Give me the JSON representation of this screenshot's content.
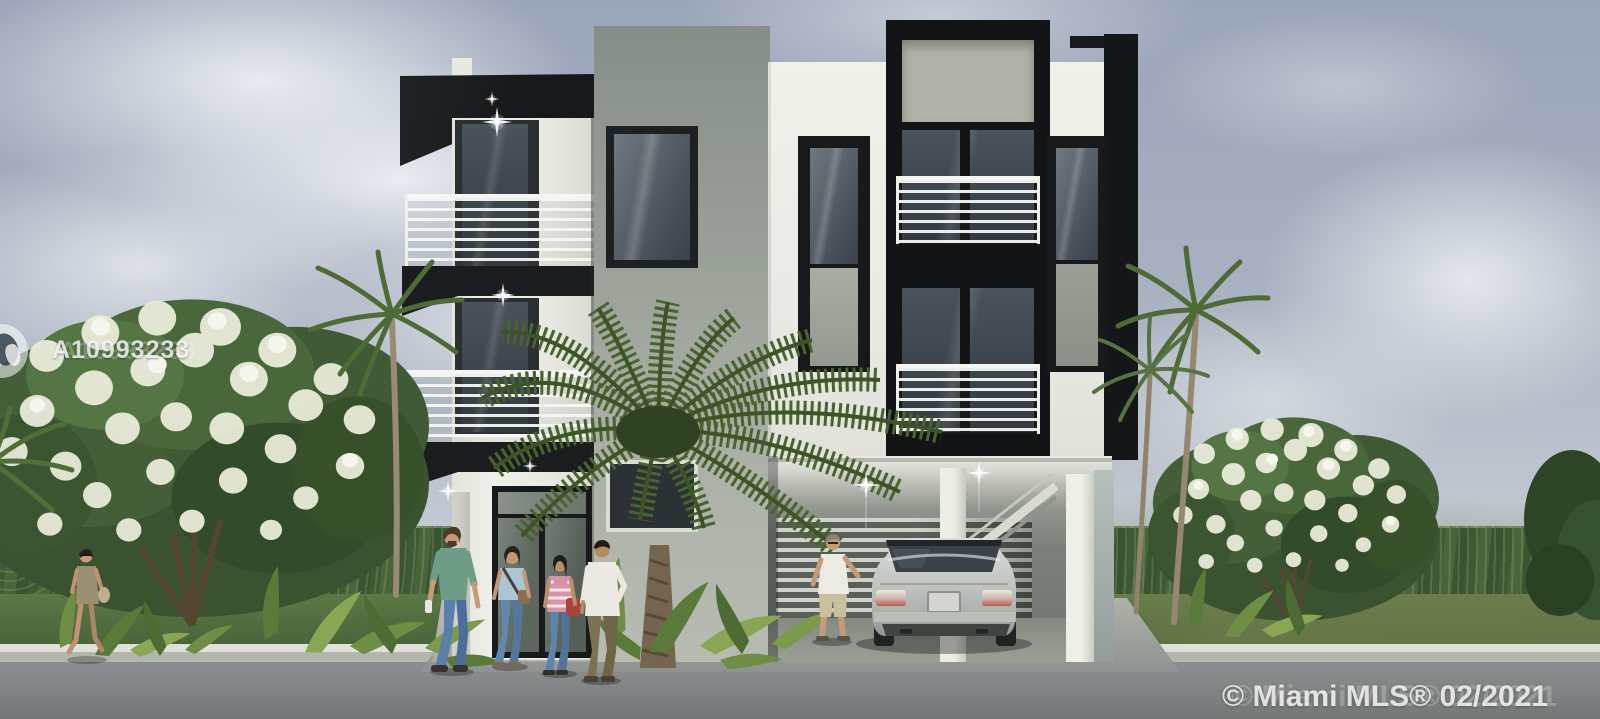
{
  "watermarks": {
    "mls_number": "A10993233",
    "copyright": "© Miami MLS® 02/2021",
    "logo": "mls-circle-logo"
  },
  "palette": {
    "sky_top": "#9fa9bc",
    "sky_horizon": "#d6dadd",
    "cloud_white": "#eef0f3",
    "building_white": "#edeee8",
    "building_gray": "#a0a59d",
    "building_black": "#17191b",
    "window_glass": "#4a525a",
    "railing_white": "#f4f5f2",
    "palm_green": "#4e6a35",
    "hedge_green": "#46613a",
    "lawn_green": "#546f40",
    "road_gray": "#85888a",
    "curb_gray": "#c6c7c0",
    "driveway_gray": "#a8aca5",
    "car_silver": "#c9ccc9",
    "flower_white": "#eef0e0"
  },
  "scene": {
    "objects": [
      "modern-three-story-building",
      "black-cantilever-canopy",
      "cable-rail-balconies",
      "open-carport",
      "silver-sedan-rear-view",
      "canary-palm-tree",
      "slender-palm-trees",
      "white-flowering-trees",
      "tropical-ground-plants",
      "background-hedge",
      "lawn",
      "street-asphalt",
      "six-people",
      "lens-flare-sparkles"
    ]
  }
}
